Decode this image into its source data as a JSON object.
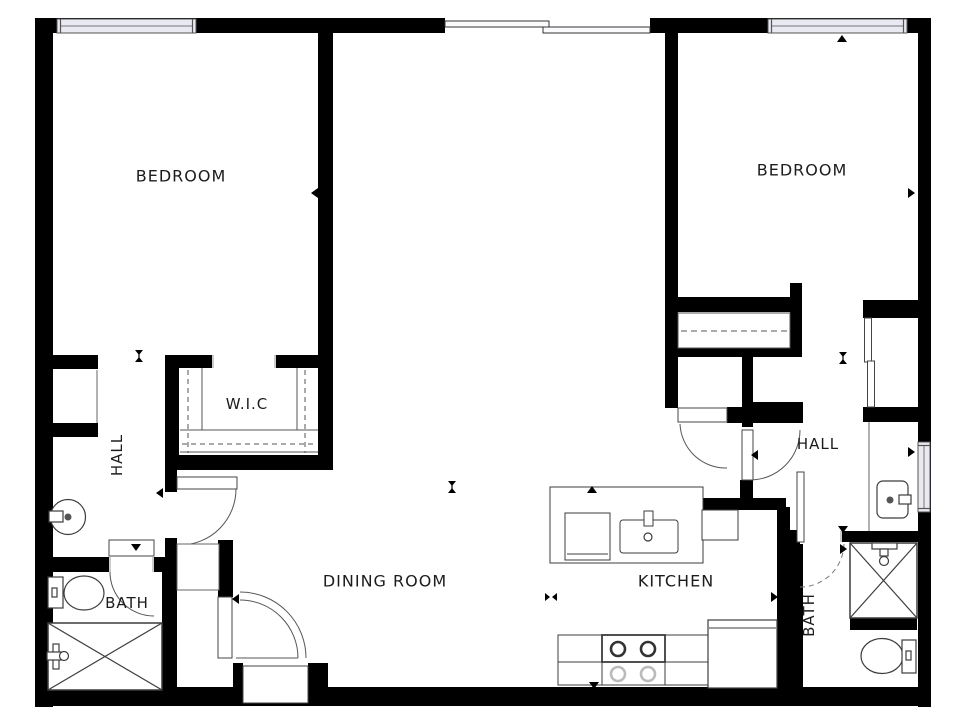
{
  "rooms": {
    "bedroom_left": {
      "label": "BEDROOM"
    },
    "bedroom_right": {
      "label": "BEDROOM"
    },
    "walk_in_closet": {
      "label": "W.I.C"
    },
    "hall_left": {
      "label": "HALL"
    },
    "hall_right": {
      "label": "HALL"
    },
    "bath_left": {
      "label": "BATH"
    },
    "bath_right": {
      "label": "BATH"
    },
    "dining_room": {
      "label": "DINING ROOM"
    },
    "kitchen": {
      "label": "KITCHEN"
    }
  },
  "colors": {
    "wall": "#000000",
    "window_fill": "#e9e9f1",
    "line": "#3c3c3c",
    "background": "#ffffff"
  },
  "fixtures": [
    "round-sink",
    "toilet",
    "shower",
    "kitchen-sink",
    "dishwasher",
    "stove",
    "refrigerator",
    "vanity-sink",
    "shower",
    "toilet",
    "closet-rod",
    "sliding-closet-doors"
  ]
}
